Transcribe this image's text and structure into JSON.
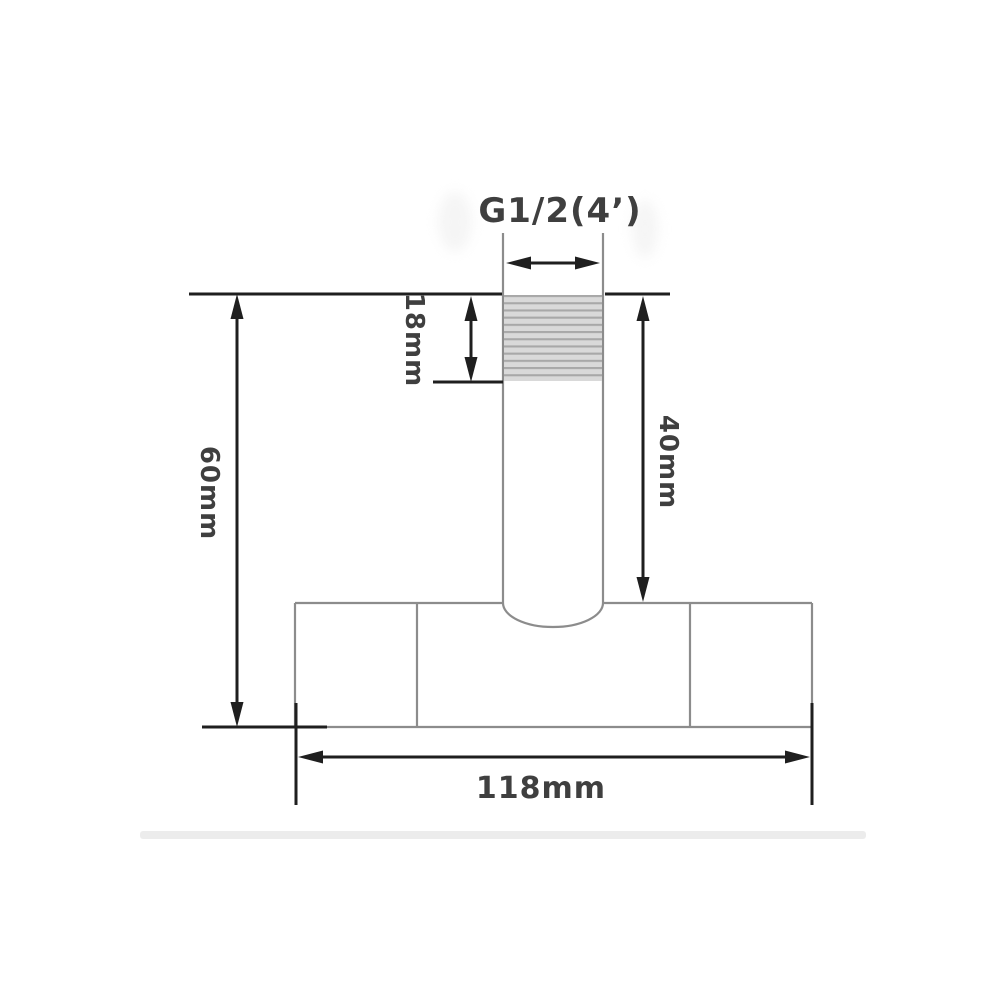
{
  "figure": {
    "kind": "technical-dimension-drawing",
    "subject": "wall/ceiling mount pipe fitting cross-section with thread"
  },
  "labels": {
    "thread_spec": "G1/2(4’)",
    "thread_length": "18mm",
    "pipe_length": "40mm",
    "total_height": "60mm",
    "base_width": "118mm"
  },
  "values": {
    "thread_spec": "G1/2(4’)",
    "thread_length_mm": 18,
    "pipe_exposed_length_mm": 40,
    "overall_height_mm": 60,
    "base_width_mm": 118
  },
  "colors": {
    "background": "#ffffff",
    "outline_gray": "#8c8c8c",
    "dimension_black": "#1f1f1f",
    "label_text": "#3f3f3f",
    "thread_fill": "#d9d9d9",
    "thread_stripe": "#a8a8a8",
    "divider_strip": "#ececec"
  }
}
